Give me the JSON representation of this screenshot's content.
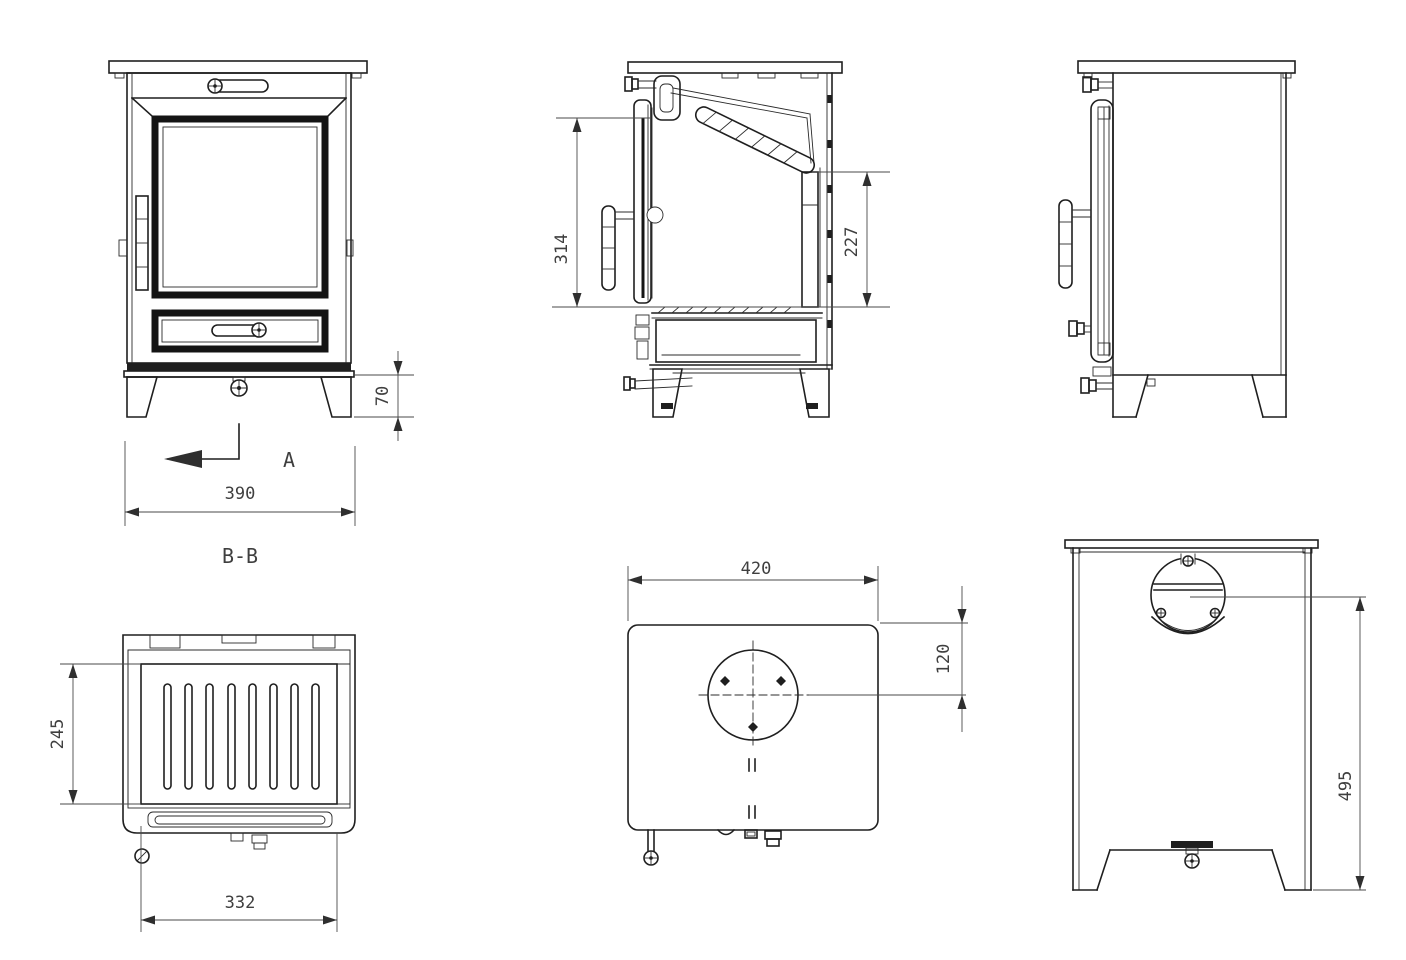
{
  "drawing": {
    "front": {
      "dim_width": "390",
      "dim_leg_height": "70",
      "cutting_arrow_label": "A",
      "section_label": "B-B"
    },
    "section": {
      "dim_door_glass_height": "314",
      "dim_firebox_rear_height": "227"
    },
    "bb_section": {
      "dim_inner_depth": "245",
      "dim_inner_width": "332"
    },
    "top": {
      "dim_width": "420",
      "dim_flue_center_offset": "120"
    },
    "rear": {
      "dim_flue_center_to_floor": "495"
    }
  },
  "colors": {
    "line": "#1f1f1f",
    "dim_text": "#3f3f3f",
    "background": "#ffffff"
  }
}
